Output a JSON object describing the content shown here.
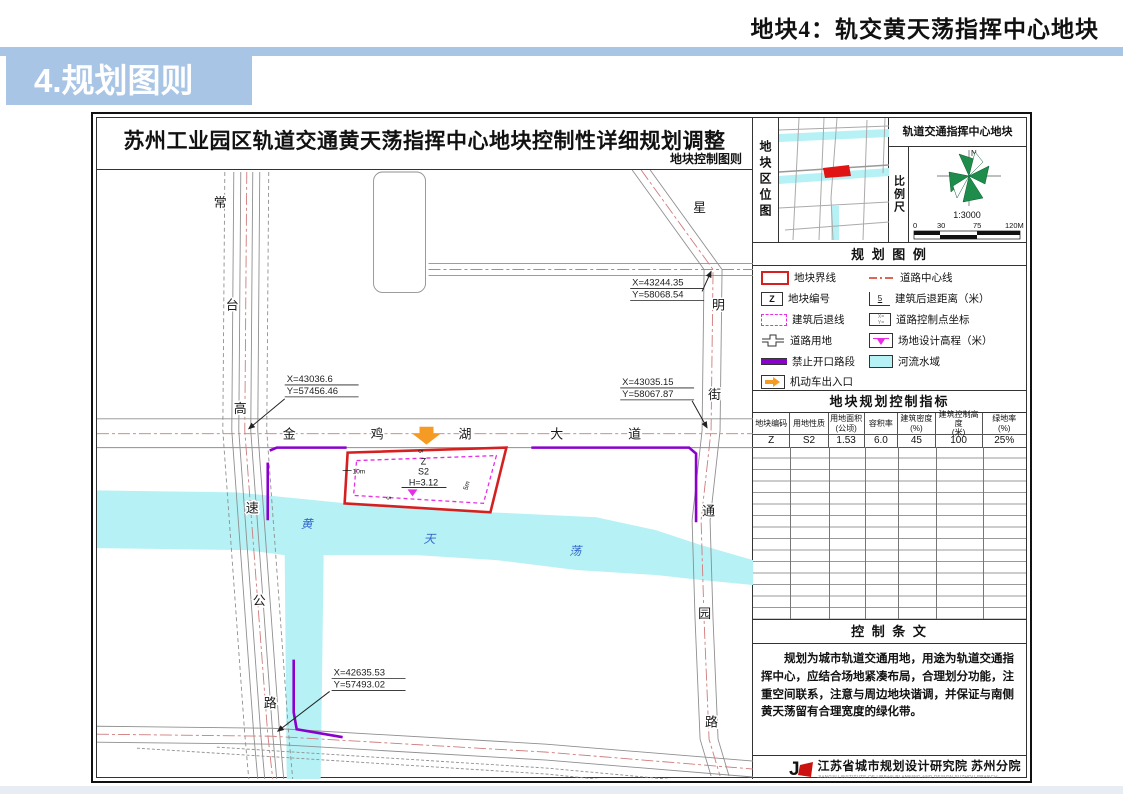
{
  "page": {
    "header_title": "地块4：轨交黄天荡指挥中心地块",
    "section_banner": "4.规划图则"
  },
  "sheet": {
    "title": "苏州工业园区轨道交通黄天荡指挥中心地块控制性详细规划调整",
    "subtitle": "地块控制图则"
  },
  "location": {
    "label": "地块区位图",
    "header": "轨道交通指挥中心地块",
    "scale_label": "比例尺",
    "north_label": "N",
    "scale_ratio": "1:3000",
    "scale_ticks": [
      "0",
      "30",
      "75",
      "120M"
    ]
  },
  "legend": {
    "title": "规 划 图 例",
    "left": [
      {
        "icon": "plot-boundary",
        "label": "地块界线"
      },
      {
        "icon": "plot-code",
        "label": "地块编号",
        "symbol": "Z"
      },
      {
        "icon": "setback-line",
        "label": "建筑后退线"
      },
      {
        "icon": "road-land",
        "label": "道路用地"
      },
      {
        "icon": "no-access",
        "label": "禁止开口路段"
      },
      {
        "icon": "vehicle-entrance",
        "label": "机动车出入口"
      }
    ],
    "right": [
      {
        "icon": "road-centerline",
        "label": "道路中心线"
      },
      {
        "icon": "setback-distance",
        "label": "建筑后退距离（米）",
        "symbol": "5"
      },
      {
        "icon": "road-control-point",
        "label": "道路控制点坐标"
      },
      {
        "icon": "site-elevation",
        "label": "场地设计高程（米）"
      },
      {
        "icon": "river",
        "label": "河流水域"
      }
    ]
  },
  "indicators": {
    "title": "地块规划控制指标",
    "headers": [
      "地块编码",
      "用地性质",
      "用地面积\n(公顷)",
      "容积率",
      "建筑密度\n(%)",
      "建筑控制高度\n(米)",
      "绿地率\n(%)"
    ],
    "row": [
      "Z",
      "S2",
      "1.53",
      "6.0",
      "45",
      "100",
      "25%"
    ]
  },
  "provisions": {
    "title": "控 制 条 文",
    "text": "规划为城市轨道交通用地，用途为轨道交通指挥中心，应结合场地紧凑布局，合理划分功能，注重空间联系，注意与周边地块谐调，并保证与南侧黄天荡留有合理宽度的绿化带。"
  },
  "footer": {
    "org_cn": "江苏省城市规划设计研究院  苏州分院",
    "org_en": "JIANGSU INSTITUTE OF URBAN PLANNING AND DESIGN   SUZHOU BRANCH"
  },
  "map": {
    "road_changtai": [
      "常",
      "台",
      "高",
      "速",
      "公",
      "路"
    ],
    "road_jinjihu": [
      "金",
      "鸡",
      "湖",
      "大",
      "道"
    ],
    "road_xingming": [
      "星",
      "明",
      "街"
    ],
    "road_tongyuan": [
      "通",
      "园",
      "路"
    ],
    "water_name": [
      "黄",
      "天",
      "荡"
    ],
    "plot": {
      "code": "Z",
      "use": "S2",
      "elevation": "H=3.12",
      "setback_left": "10m",
      "setback_right": "5m",
      "setback_top": "5",
      "setback_bottom": "5"
    },
    "coordinates": [
      {
        "x": "X=43244.35",
        "y": "Y=58068.54"
      },
      {
        "x": "X=43035.15",
        "y": "Y=58067.87"
      },
      {
        "x": "X=43036.6",
        "y": "Y=57456.46"
      },
      {
        "x": "X=42635.53",
        "y": "Y=57493.02"
      }
    ]
  },
  "colors": {
    "banner_blue": "#a9c5e6",
    "plot_red": "#d42020",
    "setback_magenta": "#e62ee6",
    "no_access_purple": "#8a00cc",
    "water_cyan": "#b5f1f5",
    "entrance_orange": "#f59a23",
    "compass_green": "#1e8c4a",
    "centerline_red": "#cf7b7b"
  }
}
